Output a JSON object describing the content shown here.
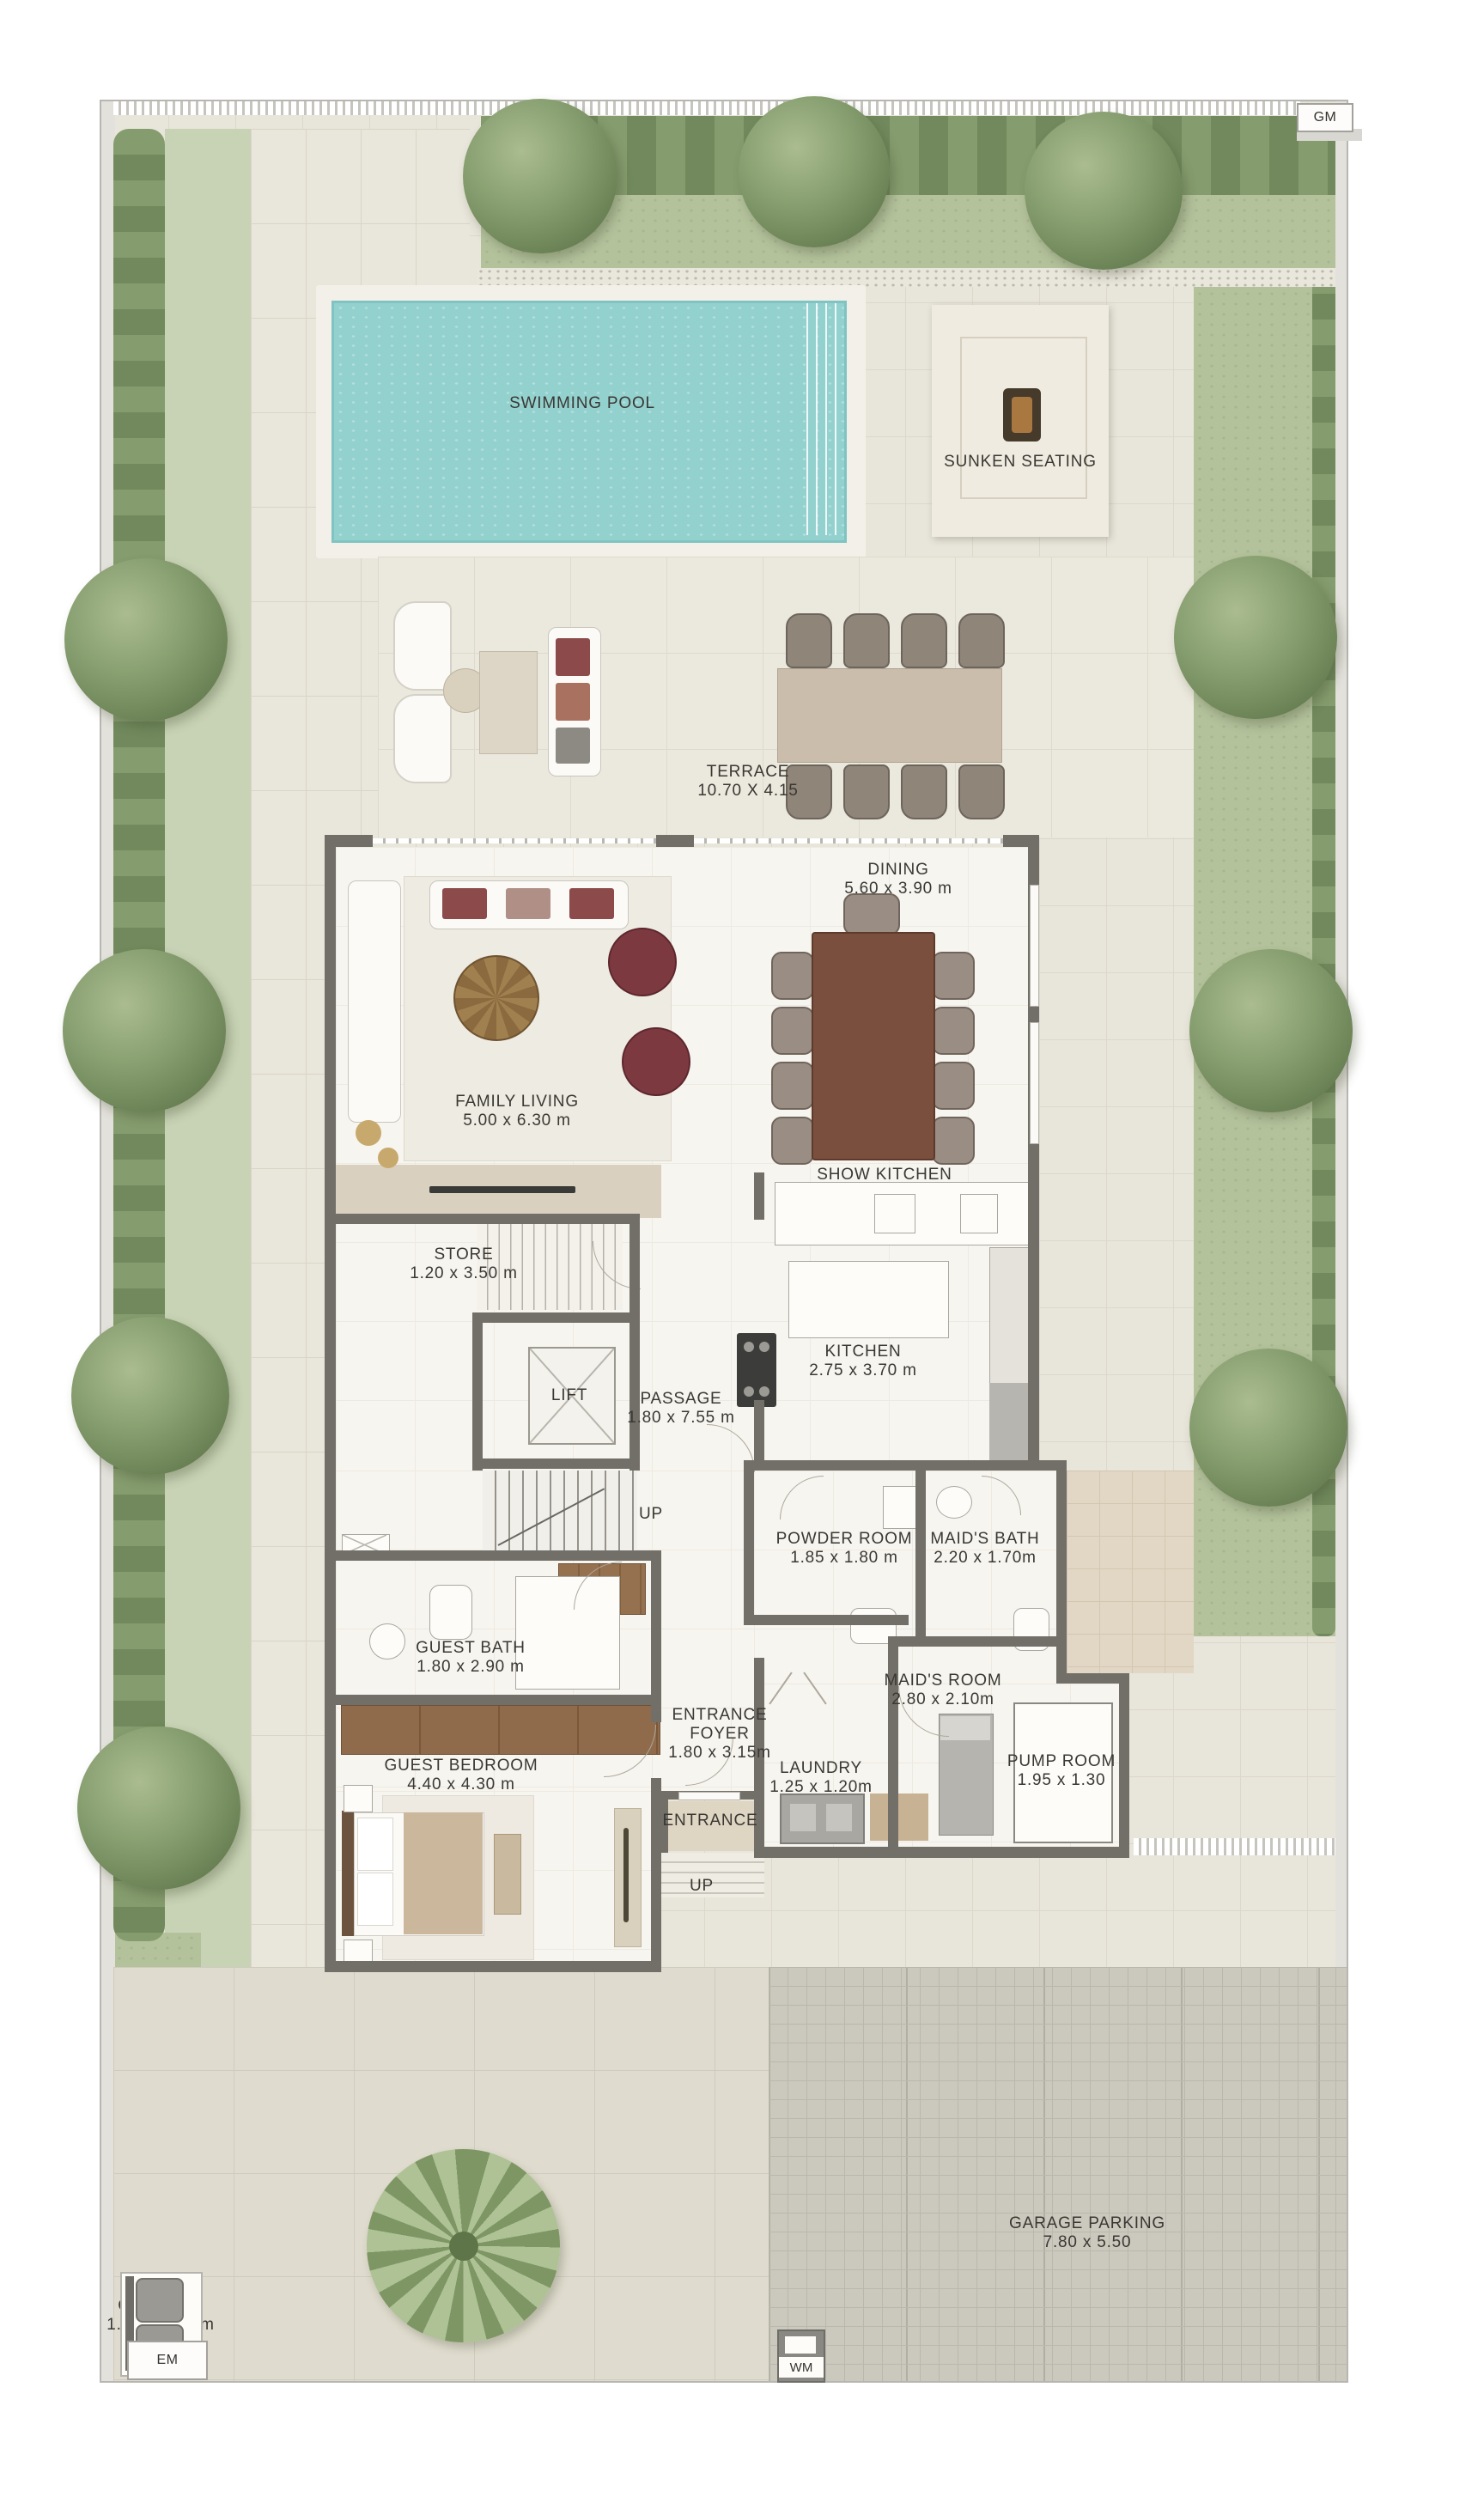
{
  "site": {
    "gm": "GM",
    "em": "EM",
    "wm": "WM",
    "swimming_pool": "SWIMMING POOL",
    "sunken_seating": "SUNKEN SEATING",
    "terrace": {
      "label": "TERRACE",
      "dims": "10.70 X 4.15"
    },
    "garage": {
      "label": "GARAGE PARKING",
      "dims": "7.80 x 5.50"
    },
    "garbage": {
      "label": "GARBAGE",
      "dims": "1.55 x 1.00 m"
    },
    "entrance": "ENTRANCE",
    "up_entry": "UP"
  },
  "rooms": {
    "family_living": {
      "label": "FAMILY LIVING",
      "dims": "5.00 x 6.30 m"
    },
    "dining": {
      "label": "DINING",
      "dims": "5.60 x 3.90 m"
    },
    "show_kitchen": {
      "label": "SHOW KITCHEN"
    },
    "kitchen": {
      "label": "KITCHEN",
      "dims": "2.75 x 3.70 m"
    },
    "store": {
      "label": "STORE",
      "dims": "1.20 x 3.50 m"
    },
    "lift": {
      "label": "LIFT"
    },
    "passage": {
      "label": "PASSAGE",
      "dims": "1.80 x 7.55 m"
    },
    "up": "UP",
    "powder_room": {
      "label": "POWDER ROOM",
      "dims": "1.85 x 1.80 m"
    },
    "maids_bath": {
      "label": "MAID'S BATH",
      "dims": "2.20 x 1.70m"
    },
    "guest_bath": {
      "label": "GUEST BATH",
      "dims": "1.80 x 2.90 m"
    },
    "maids_room": {
      "label": "MAID'S ROOM",
      "dims": "2.80 x 2.10m"
    },
    "guest_bedroom": {
      "label": "GUEST BEDROOM",
      "dims": "4.40 x 4.30 m"
    },
    "entrance_foyer": {
      "line1": "ENTRANCE",
      "line2": "FOYER",
      "dims": "1.80 x 3.15m"
    },
    "laundry": {
      "label": "LAUNDRY",
      "dims": "1.25 x 1.20m"
    },
    "pump_room": {
      "label": "PUMP ROOM",
      "dims": "1.95 x 1.30"
    }
  },
  "colors": {
    "pool": "#93d1cf",
    "grass": "#b4c29c",
    "wall": "#716f68",
    "wood": "#8f6b4c",
    "paving": "#e8e5da"
  }
}
